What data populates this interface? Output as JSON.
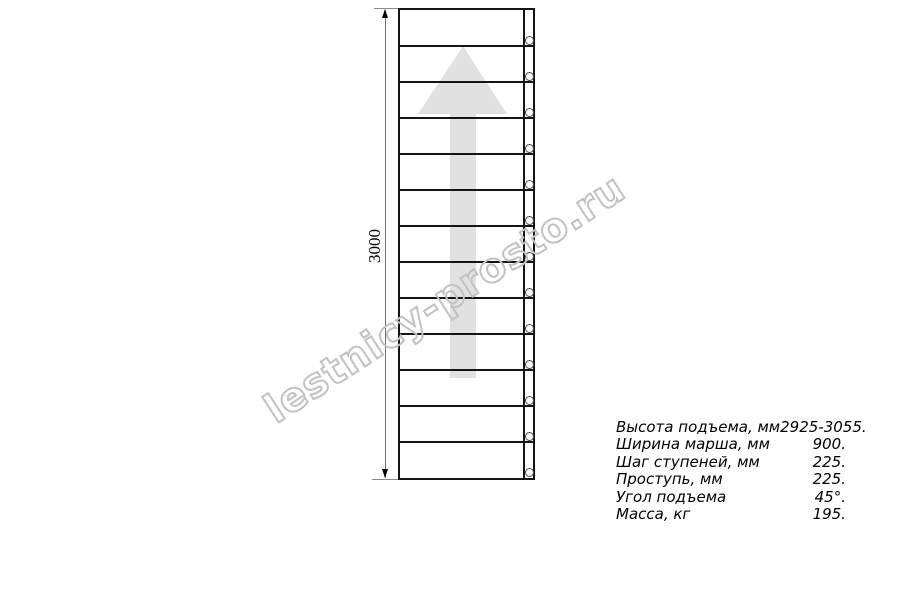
{
  "watermark": {
    "text": "lestnicy-prosto.ru",
    "stroke_color": "#c2c2c2"
  },
  "drawing": {
    "dimension_label": "3000",
    "step_count": 13,
    "bolt_count": 13,
    "arrow_color": "#e1e1e1",
    "line_color": "#141414"
  },
  "specs": {
    "rows": [
      {
        "label": "Высота подъема, мм",
        "value": "2925-3055."
      },
      {
        "label": "Ширина марша, мм",
        "value": "900."
      },
      {
        "label": "Шаг ступеней, мм",
        "value": "225."
      },
      {
        "label": "Проступь, мм",
        "value": "225."
      },
      {
        "label": "Угол подъема",
        "value": "45°."
      },
      {
        "label": "Масса, кг",
        "value": "195."
      }
    ]
  }
}
